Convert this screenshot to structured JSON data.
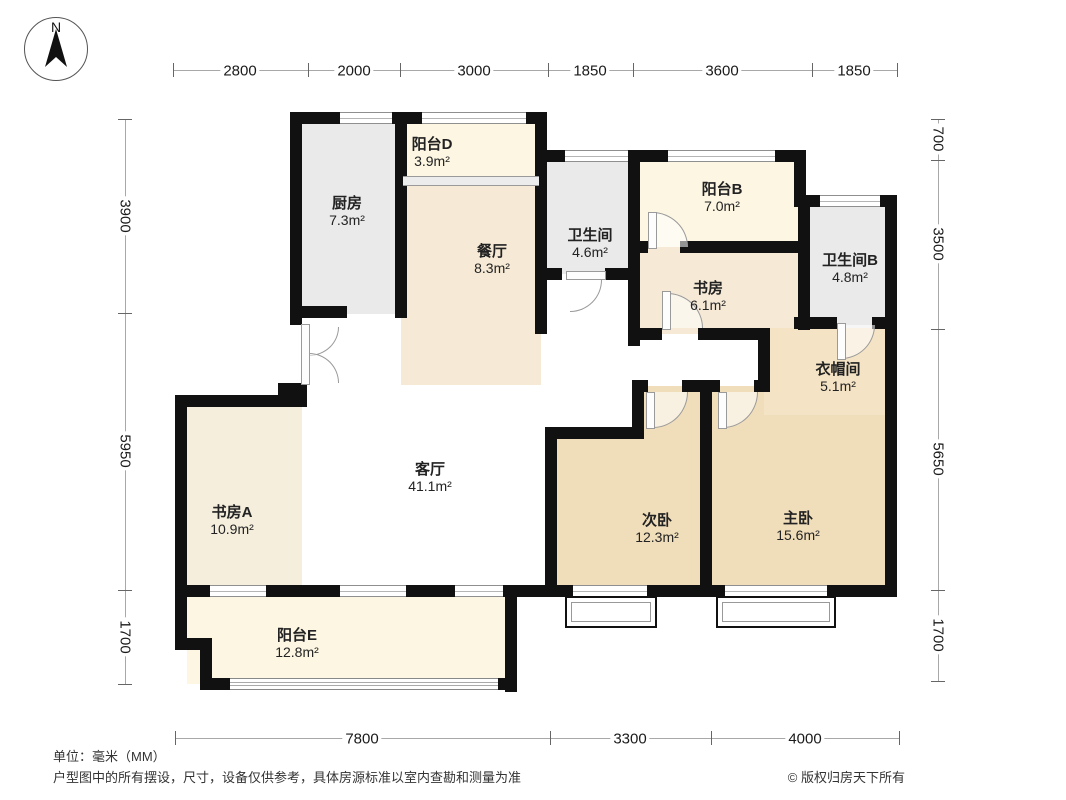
{
  "compass": {
    "label": "N"
  },
  "rooms": [
    {
      "id": "kitchen",
      "name": "厨房",
      "area": "7.3m²"
    },
    {
      "id": "balcony-d",
      "name": "阳台D",
      "area": "3.9m²"
    },
    {
      "id": "dining-room",
      "name": "餐厅",
      "area": "8.3m²"
    },
    {
      "id": "bathroom",
      "name": "卫生间",
      "area": "4.6m²"
    },
    {
      "id": "balcony-b",
      "name": "阳台B",
      "area": "7.0m²"
    },
    {
      "id": "study",
      "name": "书房",
      "area": "6.1m²"
    },
    {
      "id": "bathroom-b",
      "name": "卫生间B",
      "area": "4.8m²"
    },
    {
      "id": "cloakroom",
      "name": "衣帽间",
      "area": "5.1m²"
    },
    {
      "id": "living-room",
      "name": "客厅",
      "area": "41.1m²"
    },
    {
      "id": "study-a",
      "name": "书房A",
      "area": "10.9m²"
    },
    {
      "id": "second-bedroom",
      "name": "次卧",
      "area": "12.3m²"
    },
    {
      "id": "master-bedroom",
      "name": "主卧",
      "area": "15.6m²"
    },
    {
      "id": "balcony-e",
      "name": "阳台E",
      "area": "12.8m²"
    }
  ],
  "dimensions": {
    "top": [
      "2800",
      "2000",
      "3000",
      "1850",
      "3600",
      "1850"
    ],
    "bottom": [
      "7800",
      "3300",
      "4000"
    ],
    "left": [
      "3900",
      "5950",
      "1700"
    ],
    "right": [
      "700",
      "3500",
      "5650",
      "1700"
    ]
  },
  "footer": {
    "unit": "单位：毫米（MM）",
    "disclaimer": "户型图中的所有摆设，尺寸，设备仅供参考，具体房源标准以室内查勘和测量为准",
    "copyright": "© 版权归房天下所有"
  },
  "colors": {
    "wall": "#111111",
    "gray_room": "#eaeaea",
    "cream_room": "#fcf6e2",
    "beige_room": "#f6ead6",
    "tan_room": "#f0ddba",
    "cloak_room": "#f4e3c4",
    "study_a_room": "#f5eedd",
    "window_line": "#999999",
    "dimension_line": "#a8a8a8",
    "text": "#222222"
  }
}
